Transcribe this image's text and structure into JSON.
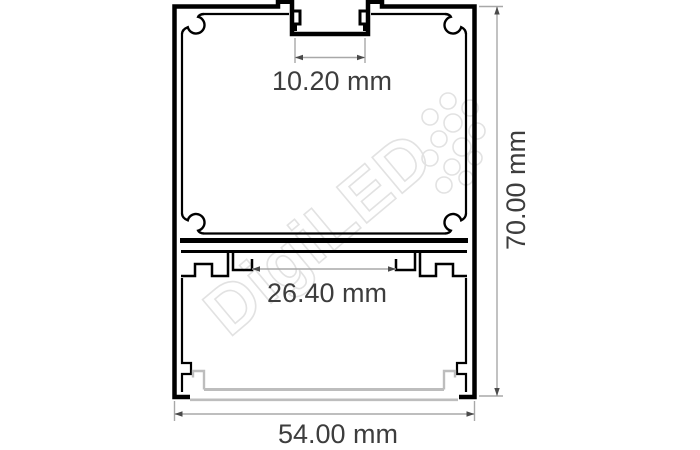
{
  "drawing": {
    "watermark": {
      "text": "DigiLED"
    },
    "dimensions": {
      "top_slot_width": "10.20 mm",
      "inner_channel_width": "26.40 mm",
      "overall_height": "70.00 mm",
      "overall_width": "54.00 mm"
    },
    "colors": {
      "background": "#ffffff",
      "profile_outline": "#000000",
      "diffuser_gray": "#bdbdbd",
      "dimension_line": "#a8a8a8",
      "dimension_arrow": "#4a4a4a",
      "dimension_text": "#3d3d3d",
      "watermark_gray": "#e2e2e2"
    }
  }
}
